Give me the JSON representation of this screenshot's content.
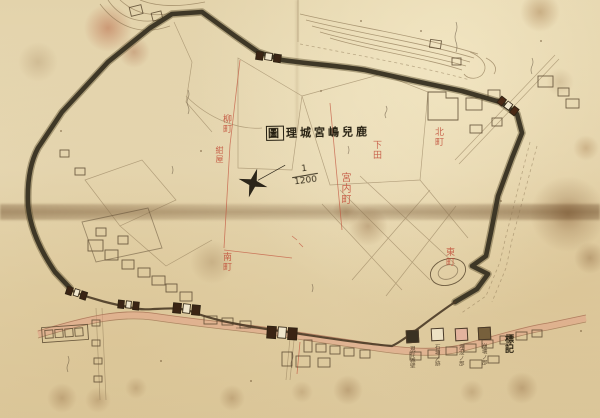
{
  "map": {
    "title": {
      "boxed_char": "圖",
      "text_after_box": "理城宮嶋兒鹿",
      "reading_note": "handwritten kanji title, read right-to-left, last character boxed"
    },
    "scale": {
      "numerator": "1",
      "denominator": "1200"
    },
    "compass_icon": "four-point-star",
    "place_labels_red": [
      {
        "text": "柳町"
      },
      {
        "text": "紺屋"
      },
      {
        "text": "宮内町"
      },
      {
        "text": "下田"
      },
      {
        "text": "北町"
      },
      {
        "text": "東町"
      },
      {
        "text": "南町"
      }
    ],
    "legend": {
      "header": "標記",
      "items": [
        {
          "label": "現存城壁",
          "swatch": "#3a3122"
        },
        {
          "label": "石垣ノ跡",
          "swatch": "#ece1c4"
        },
        {
          "label": "埋没ノ部",
          "swatch": "#e3b39e"
        },
        {
          "label": "崩壊ノ部",
          "swatch": "#77603c"
        }
      ]
    },
    "colors": {
      "paper": "#e4d5ae",
      "wall_ink": "#3e3726",
      "road_pink": "#e2ab90",
      "red_ink": "#c24f3a",
      "sepia_ink": "#6b5638"
    }
  }
}
